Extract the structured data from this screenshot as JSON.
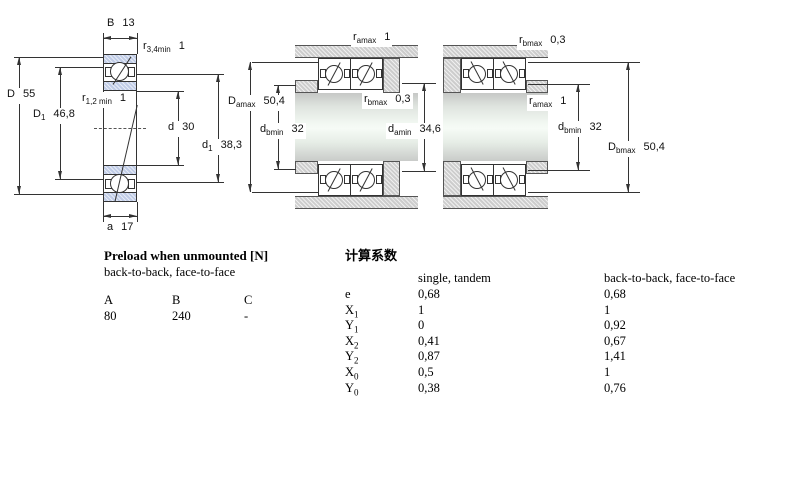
{
  "dims": {
    "B": {
      "base": "B",
      "sub": "",
      "value": "13"
    },
    "r34": {
      "base": "r",
      "sub": "3,4min",
      "value": "1"
    },
    "D": {
      "base": "D",
      "sub": "",
      "value": "55"
    },
    "D1": {
      "base": "D",
      "sub": "1",
      "value": "46,8"
    },
    "r12": {
      "base": "r",
      "sub": "1,2 min",
      "value": "1"
    },
    "d": {
      "base": "d",
      "sub": "",
      "value": "30"
    },
    "d1": {
      "base": "d",
      "sub": "1",
      "value": "38,3"
    },
    "a": {
      "base": "a",
      "sub": "",
      "value": "17"
    },
    "mid_r_amax": {
      "base": "r",
      "sub": "amax",
      "value": "1"
    },
    "mid_D_amax": {
      "base": "D",
      "sub": "amax",
      "value": "50,4"
    },
    "mid_r_bmax": {
      "base": "r",
      "sub": "bmax",
      "value": "0,3"
    },
    "mid_d_bmin": {
      "base": "d",
      "sub": "bmin",
      "value": "32"
    },
    "mid_d_amin": {
      "base": "d",
      "sub": "amin",
      "value": "34,6"
    },
    "right_r_bmax": {
      "base": "r",
      "sub": "bmax",
      "value": "0,3"
    },
    "right_r_amax": {
      "base": "r",
      "sub": "amax",
      "value": "1"
    },
    "right_d_bmin": {
      "base": "d",
      "sub": "bmin",
      "value": "32"
    },
    "right_D_bmax": {
      "base": "D",
      "sub": "bmax",
      "value": "50,4"
    }
  },
  "preload": {
    "title": "Preload when unmounted [N]",
    "subtitle": "back-to-back, face-to-face",
    "columns": [
      "A",
      "B",
      "C"
    ],
    "values": [
      "80",
      "240",
      "-"
    ]
  },
  "factors": {
    "title": "计算系数",
    "single_tandem_header": "single, tandem",
    "btb_header": "back-to-back, face-to-face",
    "rows": [
      {
        "base": "e",
        "sub": "",
        "single_tandem": "0,68",
        "back_to_back": "0,68"
      },
      {
        "base": "X",
        "sub": "1",
        "single_tandem": "1",
        "back_to_back": "1"
      },
      {
        "base": "Y",
        "sub": "1",
        "single_tandem": "0",
        "back_to_back": "0,92"
      },
      {
        "base": "X",
        "sub": "2",
        "single_tandem": "0,41",
        "back_to_back": "0,67"
      },
      {
        "base": "Y",
        "sub": "2",
        "single_tandem": "0,87",
        "back_to_back": "1,41"
      },
      {
        "base": "X",
        "sub": "0",
        "single_tandem": "0,5",
        "back_to_back": "1"
      },
      {
        "base": "Y",
        "sub": "0",
        "single_tandem": "0,38",
        "back_to_back": "0,76"
      }
    ]
  },
  "colors": {
    "ring_fill": "#c9d4ec",
    "housing_fill": "#d8d8d8",
    "line": "#333333",
    "shaft_highlight": "#f4faf4"
  }
}
